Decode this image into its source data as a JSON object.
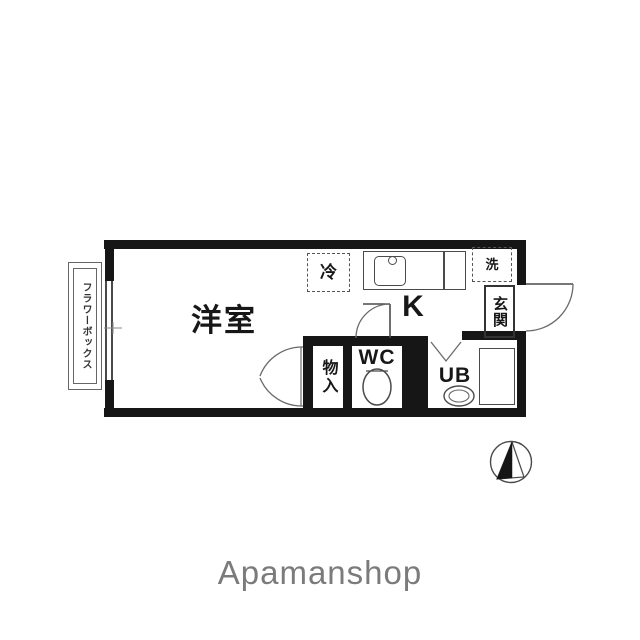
{
  "floorplan": {
    "rooms": {
      "western_room": {
        "label": "洋室"
      },
      "kitchen": {
        "label": "K"
      },
      "wc": {
        "label": "WC"
      },
      "unit_bath": {
        "label": "UB"
      },
      "entrance": {
        "label": "玄関"
      },
      "storage": {
        "label": "物入"
      }
    },
    "fixtures": {
      "refrigerator": {
        "label": "冷"
      },
      "washer": {
        "label": "洗"
      },
      "flower_box": {
        "label": "フラワーボックス"
      }
    },
    "colors": {
      "wall": "#161616",
      "line": "#4a4a4a",
      "logo_text": "#7b7b7b",
      "background": "#ffffff"
    }
  },
  "branding": {
    "logo": "Apamanshop"
  }
}
